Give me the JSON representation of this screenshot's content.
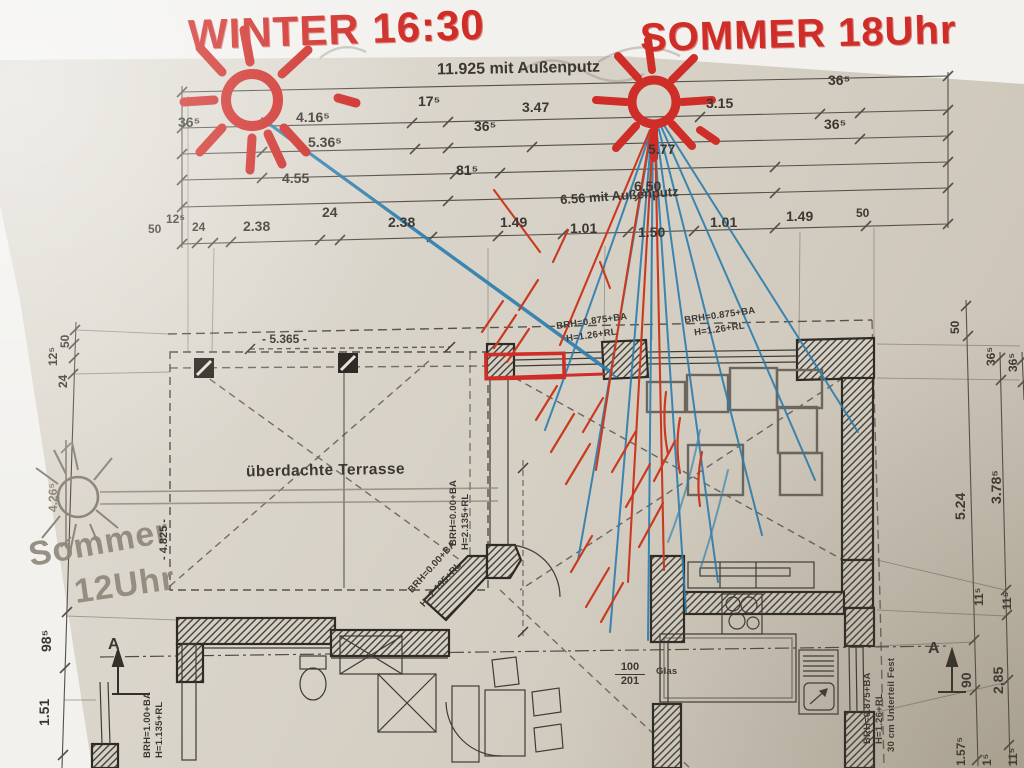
{
  "colors": {
    "marker_red": "#cf2d28",
    "pen_blue": "#2b7dae",
    "pen_red": "#c93a20",
    "pencil_gray": "#8d8779",
    "ink": "#3b3833",
    "paper": "#d8d3c8"
  },
  "handwriting": {
    "winter": "WINTER 16:30",
    "sommer_right": "SOMMER 18Uhr",
    "sommer_left_line1": "Sommer",
    "sommer_left_line2": "12Uhr"
  },
  "dims_top": {
    "total": "11.925 mit Außenputz",
    "d17": "17⁵",
    "d347": "3.47",
    "d315": "3.15",
    "d36_tr": "36⁵",
    "d36_l": "36⁵",
    "d416": "4.16⁵",
    "d36_m": "36⁵",
    "d36_r": "36⁵",
    "d536": "5.36⁵",
    "d577": "5.77",
    "d455": "4.55",
    "d81": "81⁵",
    "d650": "6.50",
    "total2": "6.56 mit Außenputz"
  },
  "dims_chain": [
    "50",
    "12⁵",
    "24",
    "2.38",
    "24",
    "2.38",
    "1.49",
    "1.01",
    "1.50",
    "1.01",
    "1.49",
    "50"
  ],
  "dims_left": {
    "d50": "50",
    "d12": "12⁵",
    "d24": "24",
    "d98": "98⁵",
    "d151": "1.51",
    "d426": "4.26⁵",
    "d4825": "- 4.825 -"
  },
  "dims_right": {
    "d50": "50",
    "d36a": "36⁵",
    "d36b": "36⁵",
    "d524": "5.24",
    "d378": "3.78⁵",
    "d11a": "11⁵",
    "d11b": "11⁵",
    "d90": "90",
    "d285": "2.85",
    "d157": "1.57⁵",
    "d1a": "1⁵",
    "d1b": "11⁵"
  },
  "plan_labels": {
    "terrace": "überdachte Terrasse",
    "dim5365": "- 5.365 -",
    "window1_l1": "BRH=0.875+BA",
    "window1_l2": "H=1.26+RL",
    "window2_l1": "BRH=0.875+BA",
    "window2_l2": "H=1.26+RL",
    "door1_l1": "BRH=0.00+BA",
    "door1_l2": "H=2.135+RL",
    "door2_l1": "BRH=0.00+BA",
    "door2_l2": "H=2.135+RL",
    "bath_l1": "BRH=1.00+BA",
    "bath_l2": "H=1.135+RL",
    "kitchen_l1": "BRH=0.875+BA",
    "kitchen_l2": "H=1.26+RL",
    "kitchen_l3": "30 cm Unterteil Fest",
    "glas": "Glas",
    "opening_top": "100",
    "opening_bottom": "201",
    "section_a_left": "A",
    "section_a_right": "A"
  }
}
